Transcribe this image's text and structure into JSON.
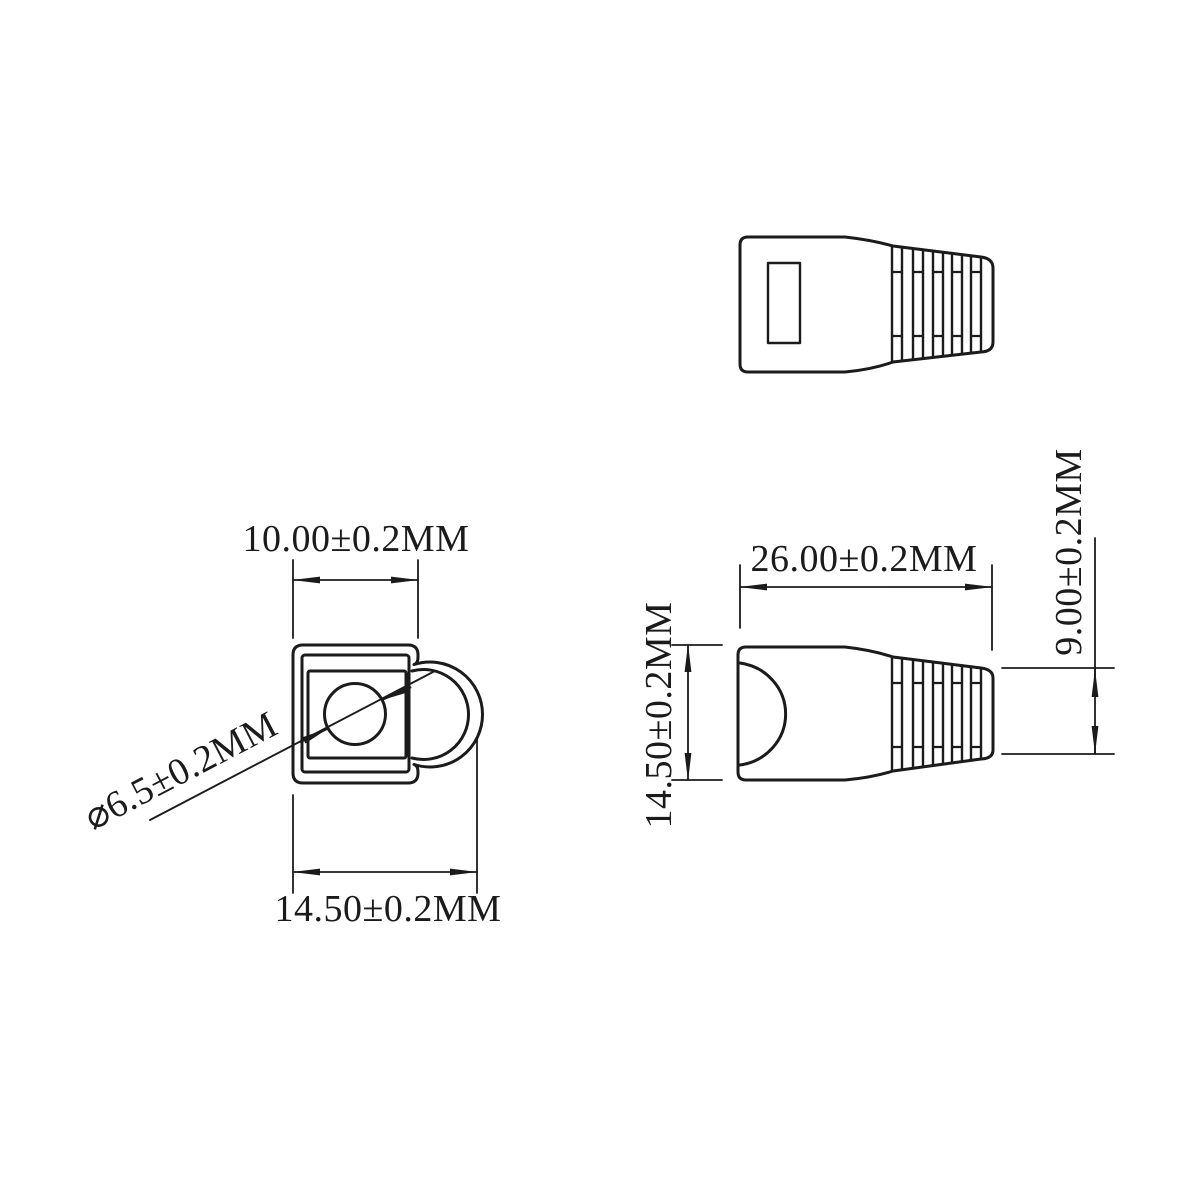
{
  "drawing": {
    "colors": {
      "line": "#1b1b1b",
      "background": "#ffffff"
    },
    "front_view": {
      "dim_square_width": "10.00±0.2MM",
      "dim_overall_width": "14.50±0.2MM",
      "dim_hole_diameter": "⌀6.5±0.2MM"
    },
    "side_view": {
      "dim_length": "26.00±0.2MM",
      "dim_height": "14.50±0.2MM",
      "dim_tail_height": "9.00±0.2MM"
    }
  }
}
